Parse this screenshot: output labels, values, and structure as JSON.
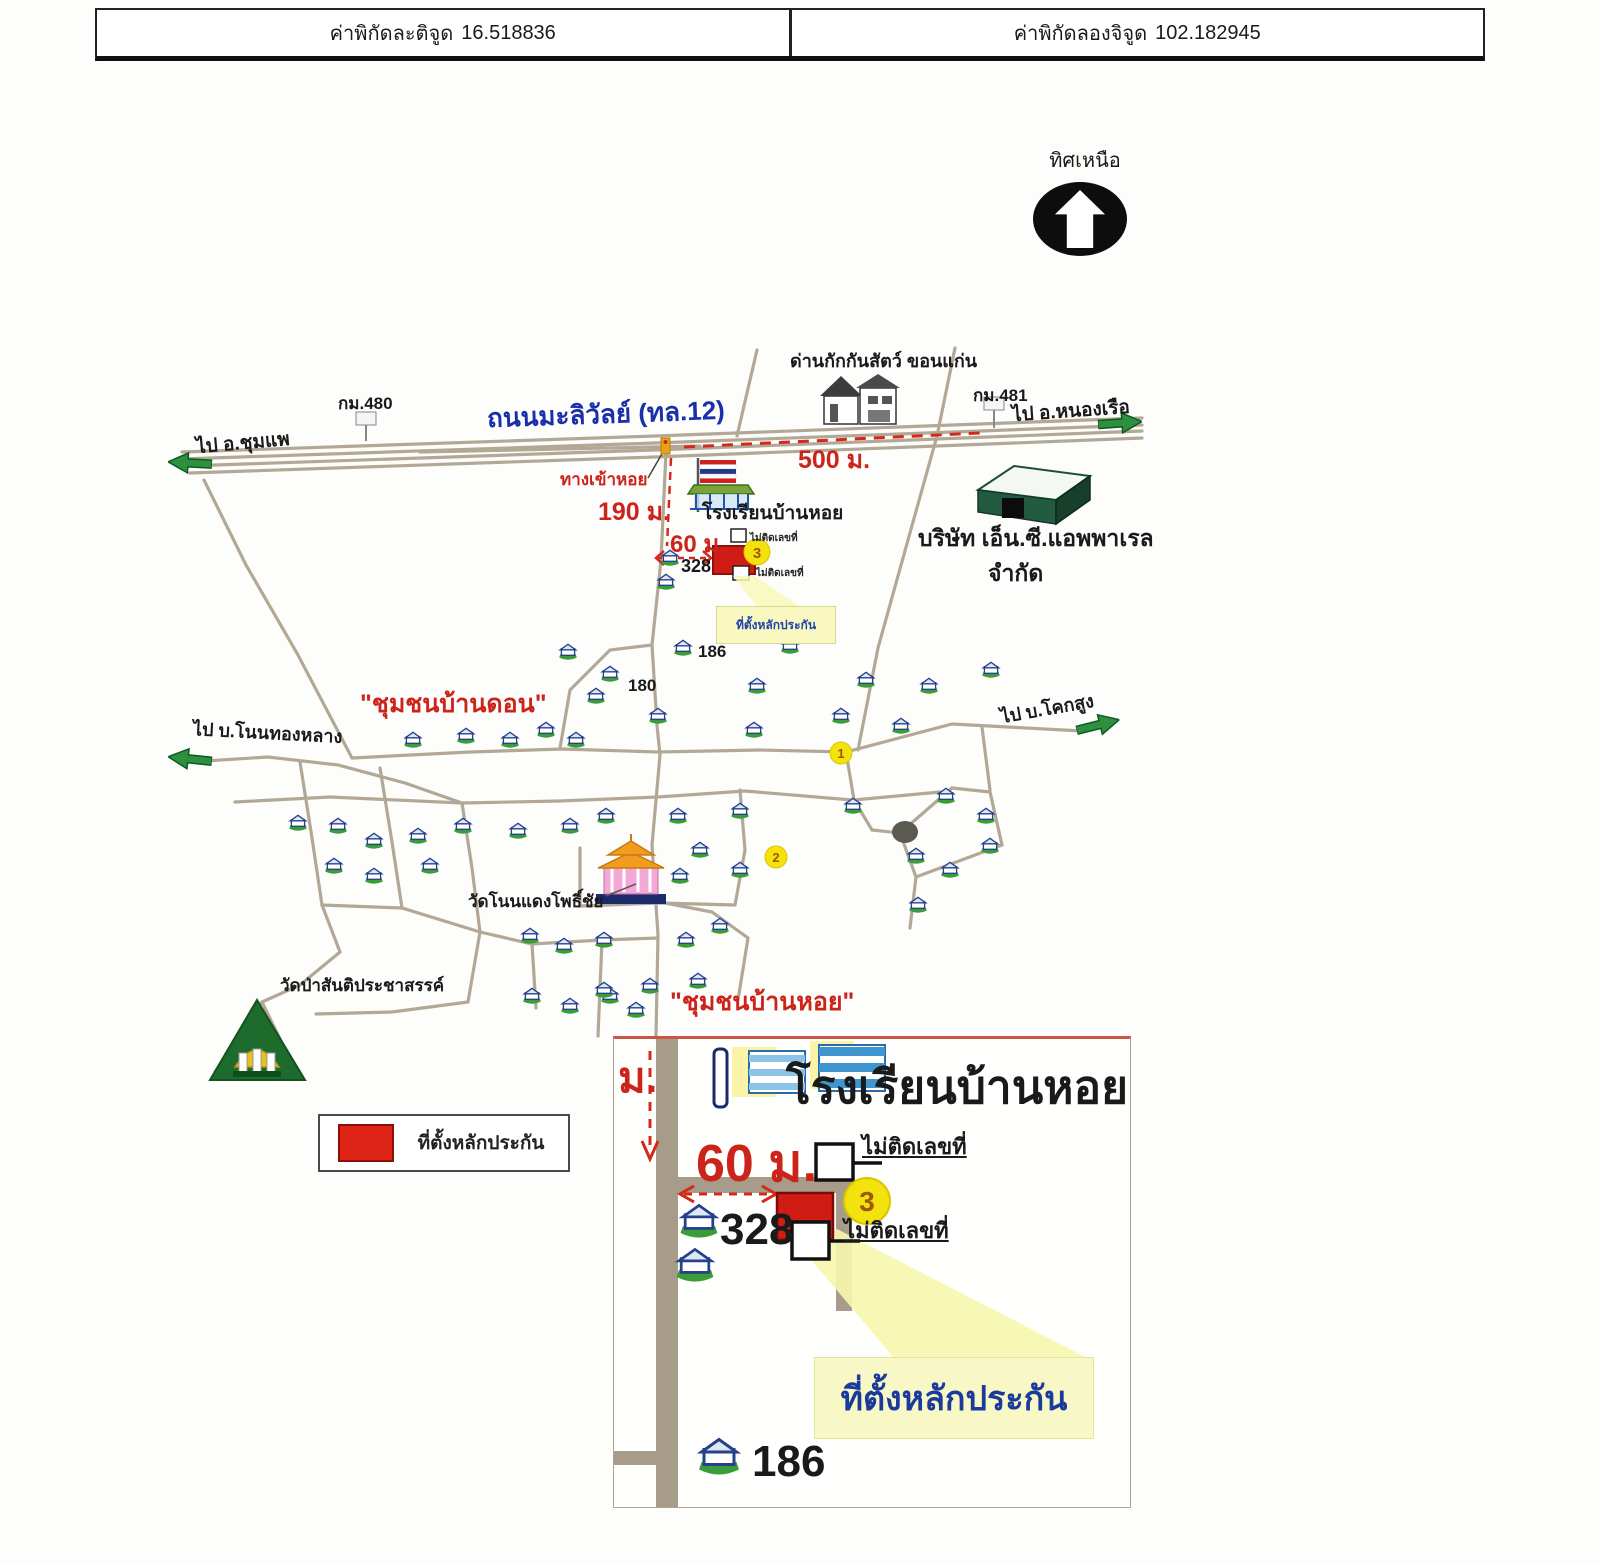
{
  "header": {
    "lat_label": "ค่าพิกัดละติจูด",
    "lat_value": "16.518836",
    "lon_label": "ค่าพิกัดลองจิจูด",
    "lon_value": "102.182945"
  },
  "compass": {
    "label": "ทิศเหนือ"
  },
  "map": {
    "road_name": "ถนนมะลิวัลย์ (ทล.12)",
    "km480": "กม.480",
    "km481": "กม.481",
    "dir_west": "ไป อ.ชุมแพ",
    "dir_east": "ไป อ.หนองเรือ",
    "dir_sw": "ไป บ.โนนทองหลาง",
    "dir_se": "ไป บ.โคกสูง",
    "quarantine": "ด่านกักกันสัตว์ ขอนแก่น",
    "entrance": "ทางเข้าหอย",
    "school": "โรงเรียนบ้านหอย",
    "company_line1": "บริษัท เอ็น.ซี.แอพพาเรล",
    "company_line2": "จำกัด",
    "community_don": "\"ชุมชนบ้านดอน\"",
    "community_hoi": "\"ชุมชนบ้านหอย\"",
    "temple_1": "วัดโนนแดงโพธิ์ชัย",
    "temple_2": "วัดป่าสันติประชาสรรค์",
    "dist_500": "500 ม.",
    "dist_190": "190 ม.",
    "dist_60": "60 ม.",
    "house_186": "186",
    "house_180": "180",
    "house_328": "328",
    "no_number": "ไม่ติดเลขที่",
    "site_label": "ที่ตั้งหลักประกัน",
    "point_1": "1",
    "point_2": "2",
    "point_3": "3"
  },
  "legend": {
    "site_label": "ที่ตั้งหลักประกัน"
  },
  "inset": {
    "school": "โรงเรียนบ้านหอย",
    "dist_60": "60 ม.",
    "dist_m": "ม.",
    "no_number_top": "ไม่ติดเลขที่",
    "no_number_bottom": "ไม่ติดเลขที่",
    "point_3": "3",
    "house_328": "328",
    "house_186": "186",
    "site_label": "ที่ตั้งหลักประกัน"
  },
  "colors": {
    "road": "#b3a896",
    "accent_red": "#cc241a",
    "road_name_blue": "#1b2fa8",
    "arrow_green": "#2e8f3e",
    "marker_yellow": "#f2e20d",
    "site_red": "#cf1d15",
    "callout_yellow": "#f8f8c6"
  }
}
